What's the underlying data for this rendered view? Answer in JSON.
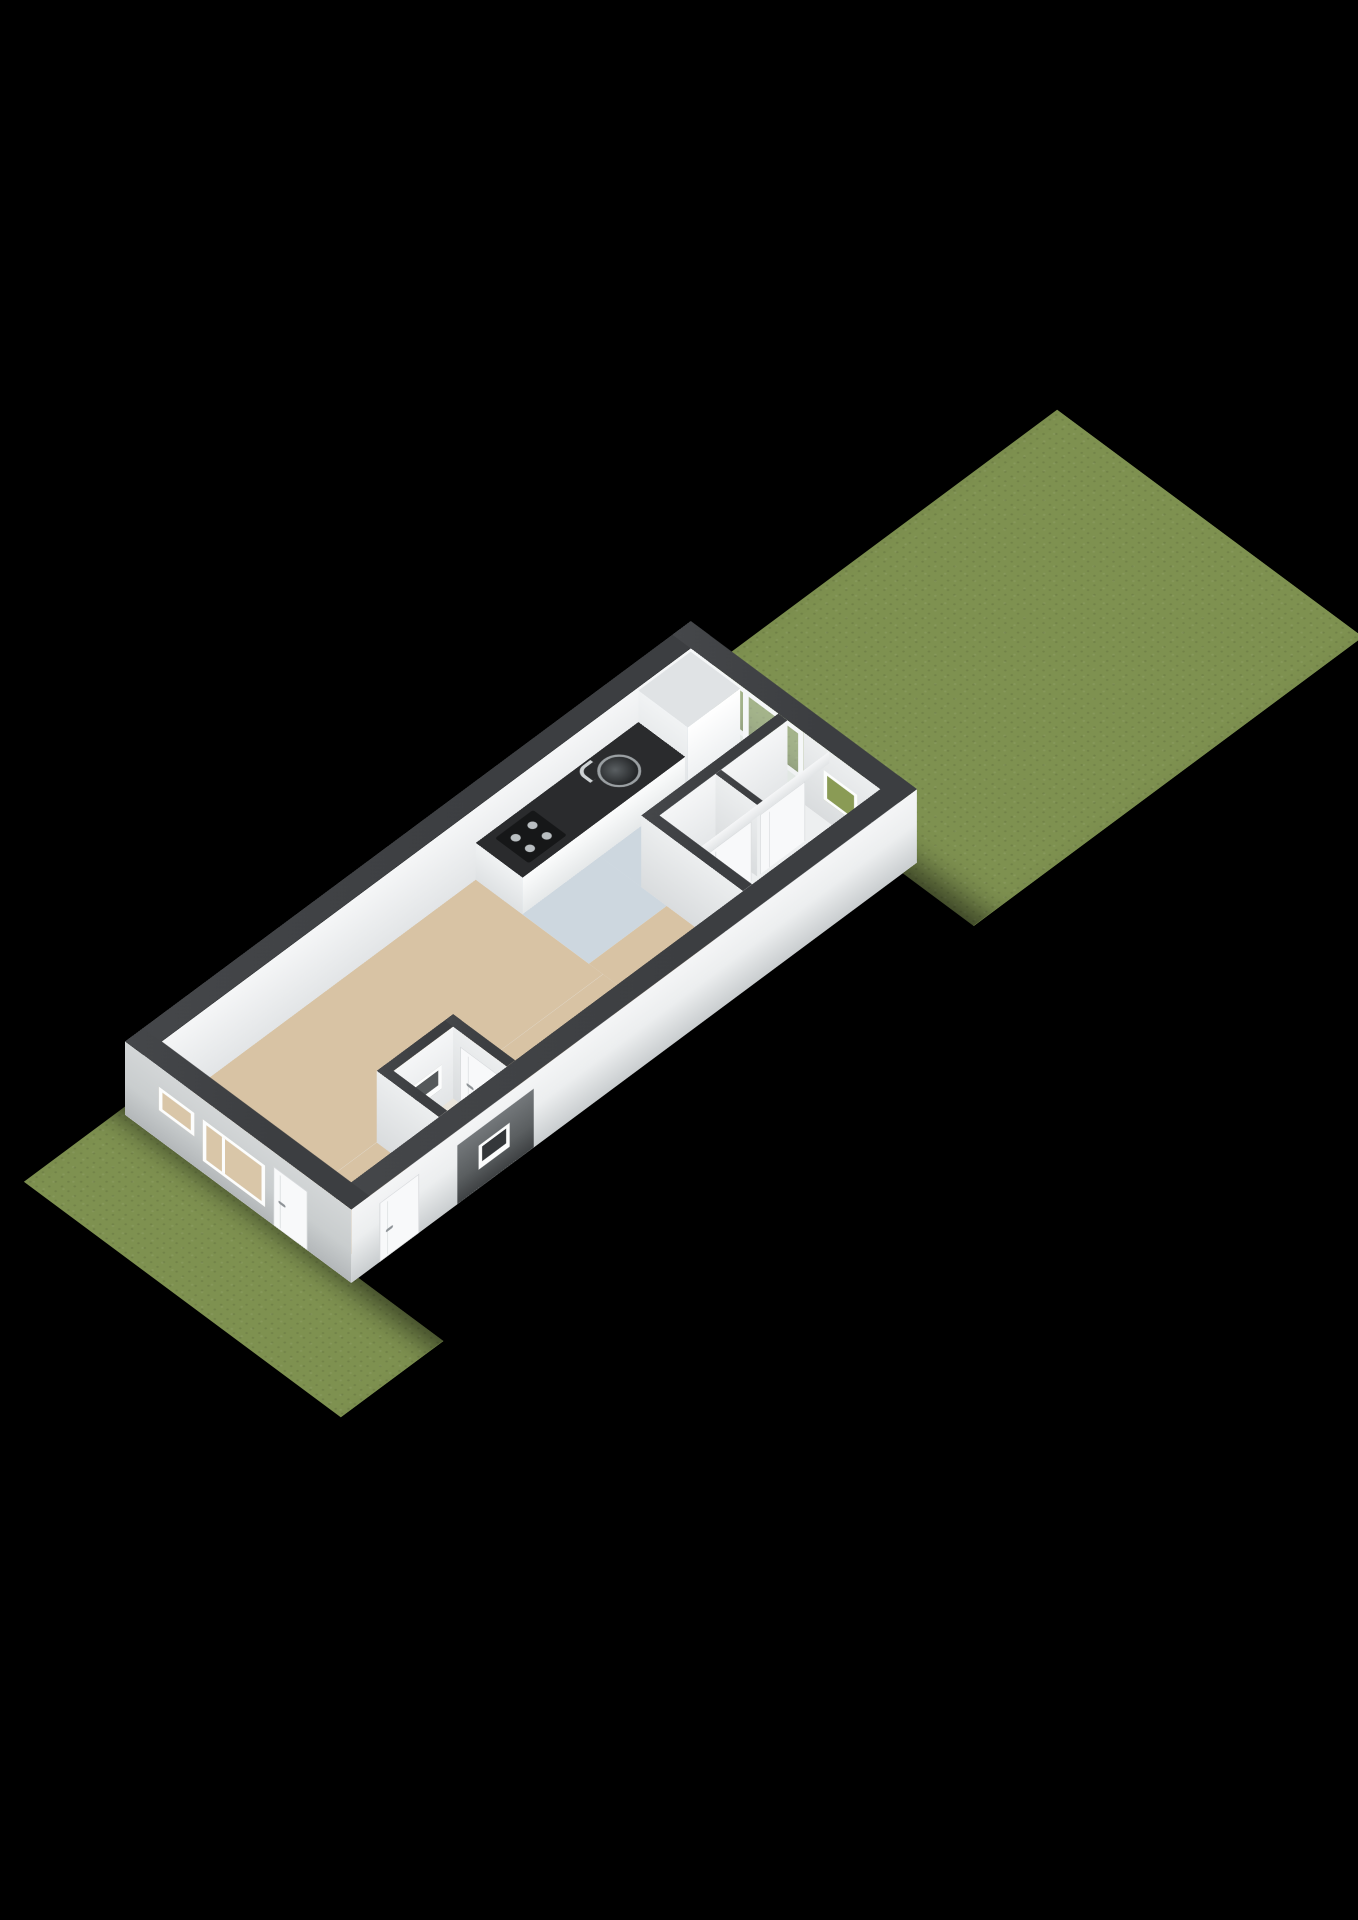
{
  "title": "3D axonometric floorplan render",
  "colors": {
    "bg": "#000000",
    "grass": "#7e9150",
    "base": "#e8eaeb",
    "floor-living": "#d8c3a4",
    "floor-kitchen": "#cdd7df",
    "floor-hall": "#edeff0",
    "floor-vestibule": "#e9e4da",
    "wall-top": "#3c3e41",
    "wall-inner": "#f5f6f7",
    "wall-outer-sw": "#c9cdce",
    "wall-outer-se": "#eceeef",
    "counter-top": "#2a2b2d",
    "counter-body": "#fafbfb",
    "glass": "rgba(216,228,220,0.42)",
    "window-garden": "#8a9b55",
    "window-interior": "#d9c6a8",
    "door": "#f8f9fa",
    "handle": "#8e9397",
    "recess": "#5a5e60",
    "step": "#e9ebec"
  },
  "scene": {
    "kind": "axonometric-3d-floorplan",
    "background": "black",
    "areas": [
      {
        "name": "back-garden",
        "surface": "grass"
      },
      {
        "name": "front-garden",
        "surface": "grass"
      },
      {
        "name": "living-room",
        "floor": "beige"
      },
      {
        "name": "kitchen",
        "floor": "blue-grey"
      },
      {
        "name": "hallway-with-closets",
        "floor": "white"
      },
      {
        "name": "entrance-vestibule",
        "floor": "light"
      }
    ],
    "fixtures": [
      {
        "name": "kitchen-counter",
        "detail": "dark worktop with sink, faucet and cooktop"
      },
      {
        "name": "tall-cabinet"
      },
      {
        "name": "glass-wall",
        "detail": "full-height glazing to back garden"
      },
      {
        "name": "small-garden-window"
      },
      {
        "name": "outdoor-step"
      },
      {
        "name": "indoor-step"
      },
      {
        "name": "closet-doors",
        "count": 2
      },
      {
        "name": "vestibule-door"
      },
      {
        "name": "facade-small-window"
      },
      {
        "name": "facade-large-window"
      },
      {
        "name": "facade-door-sw"
      },
      {
        "name": "facade-door-se"
      },
      {
        "name": "vestibule-porch-recess"
      }
    ]
  }
}
